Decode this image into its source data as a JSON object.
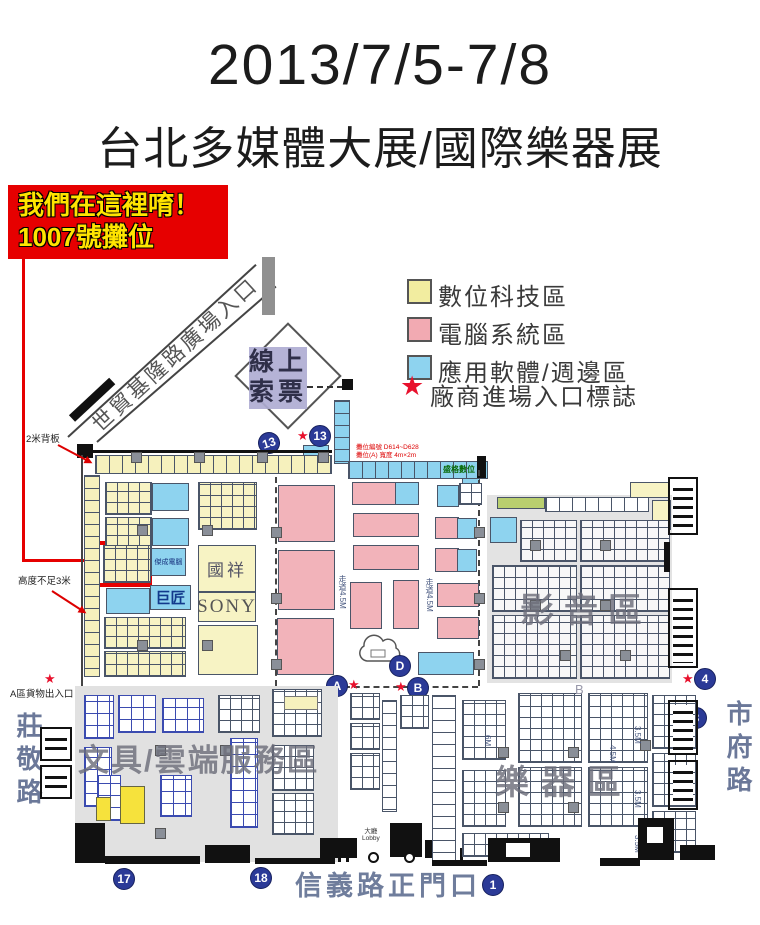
{
  "header": {
    "title": "2013/7/5-7/8",
    "subtitle": "台北多媒體大展/國際樂器展"
  },
  "callout": {
    "line1": "我們在這裡唷！",
    "line2": "1007號攤位"
  },
  "legend": {
    "digital": "數位科技區",
    "computer": "電腦系統區",
    "software": "應用軟體/週邊區",
    "entrance_mark": "廠商進場入口標誌"
  },
  "streets": {
    "plaza": "世貿基隆路廣場入口",
    "zhuangjing": "莊敬路",
    "shifu": "市府路",
    "xinyi_gate": "信義路正門口"
  },
  "zones": {
    "ticket1": "線上",
    "ticket2": "索票",
    "av": "影音區",
    "instruments": "樂器區",
    "stationery_cloud": "文具/雲端服務區",
    "zone_b": "B"
  },
  "vendors": {
    "guoxiang": "國祥",
    "sony": "SONY",
    "jujiang": "巨匠",
    "jiecheng": "傑成電腦",
    "shengge": "盛格數位"
  },
  "notes": {
    "backboard": "2米背板",
    "height_limit": "高度不足3米",
    "cargo": "A區貨物出入口",
    "booth_no": "攤位編號 D614~D628",
    "booth_size": "攤位(A) 寬度 4m×2m",
    "lobby_zh": "大廳",
    "lobby_en": "Lobby",
    "aisle_45": "走道4.5M",
    "m6": "6M",
    "m45": "4.5M",
    "m35": "3.5M"
  },
  "markers": {
    "n13a": "13",
    "n13b": "13",
    "n17": "17",
    "n18": "18",
    "n1": "1",
    "n3": "3",
    "n4": "4",
    "lA": "A",
    "lB": "B",
    "lD": "D"
  },
  "glyphs": {
    "star": "★"
  },
  "colors": {
    "digital_zone": "#f2eda0",
    "computer_zone": "#f2aab2",
    "software_zone": "#8ed3ef",
    "entrance_star": "#e8112d",
    "marker_blue": "#2b3a97",
    "callout_red": "#e60000",
    "street_text": "#6f7d9c"
  }
}
